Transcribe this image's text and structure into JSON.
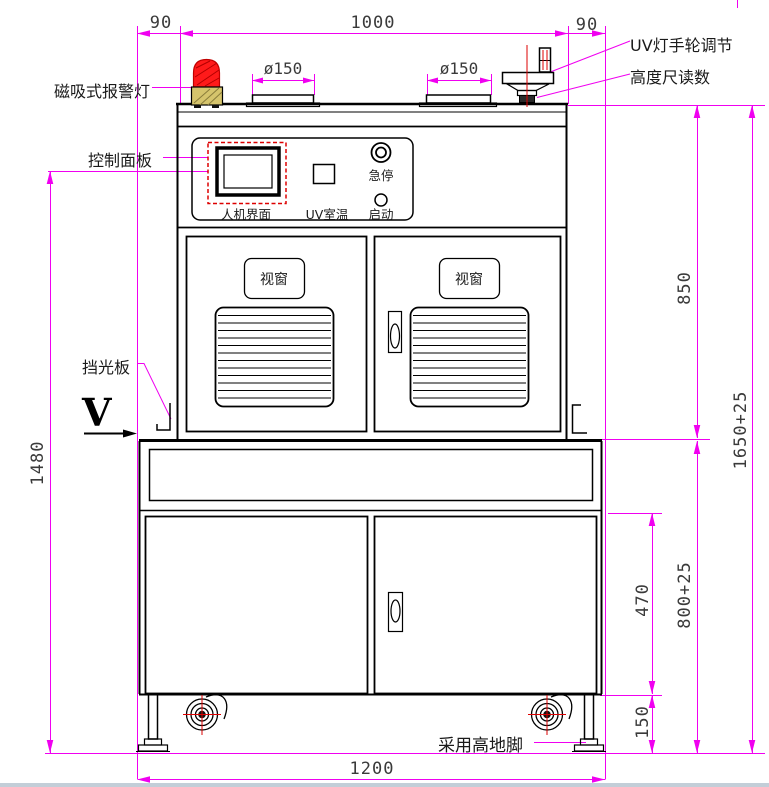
{
  "drawing": {
    "labels": {
      "alarm_light": "磁吸式报警灯",
      "control_panel": "控制面板",
      "light_shield": "挡光板",
      "view_marker": "V",
      "hmi_screen": "人机界面",
      "uv_room_temp": "UV室温",
      "emergency_stop": "急停",
      "start_button": "启动",
      "window_left": "视窗",
      "window_right": "视窗",
      "uv_handwheel": "UV灯手轮调节",
      "height_gauge": "高度尺读数",
      "feet_note": "采用高地脚"
    },
    "dimensions": {
      "left_offset": "90",
      "top_width": "1000",
      "right_offset": "90",
      "flange_left_dia": "ø150",
      "flange_right_dia": "ø150",
      "panel_height": "1480",
      "upper_height": "850",
      "total_height": "1650+25",
      "lower_door_height": "470",
      "base_height": "800+25",
      "foot_clearance": "150",
      "base_width": "1200"
    },
    "colors": {
      "dimension_line": "#ff00ff",
      "outline": "#000000",
      "beacon_dome": "#ff1a1a",
      "beacon_base": "#d5c46c",
      "marker_red": "#dd0000"
    }
  }
}
